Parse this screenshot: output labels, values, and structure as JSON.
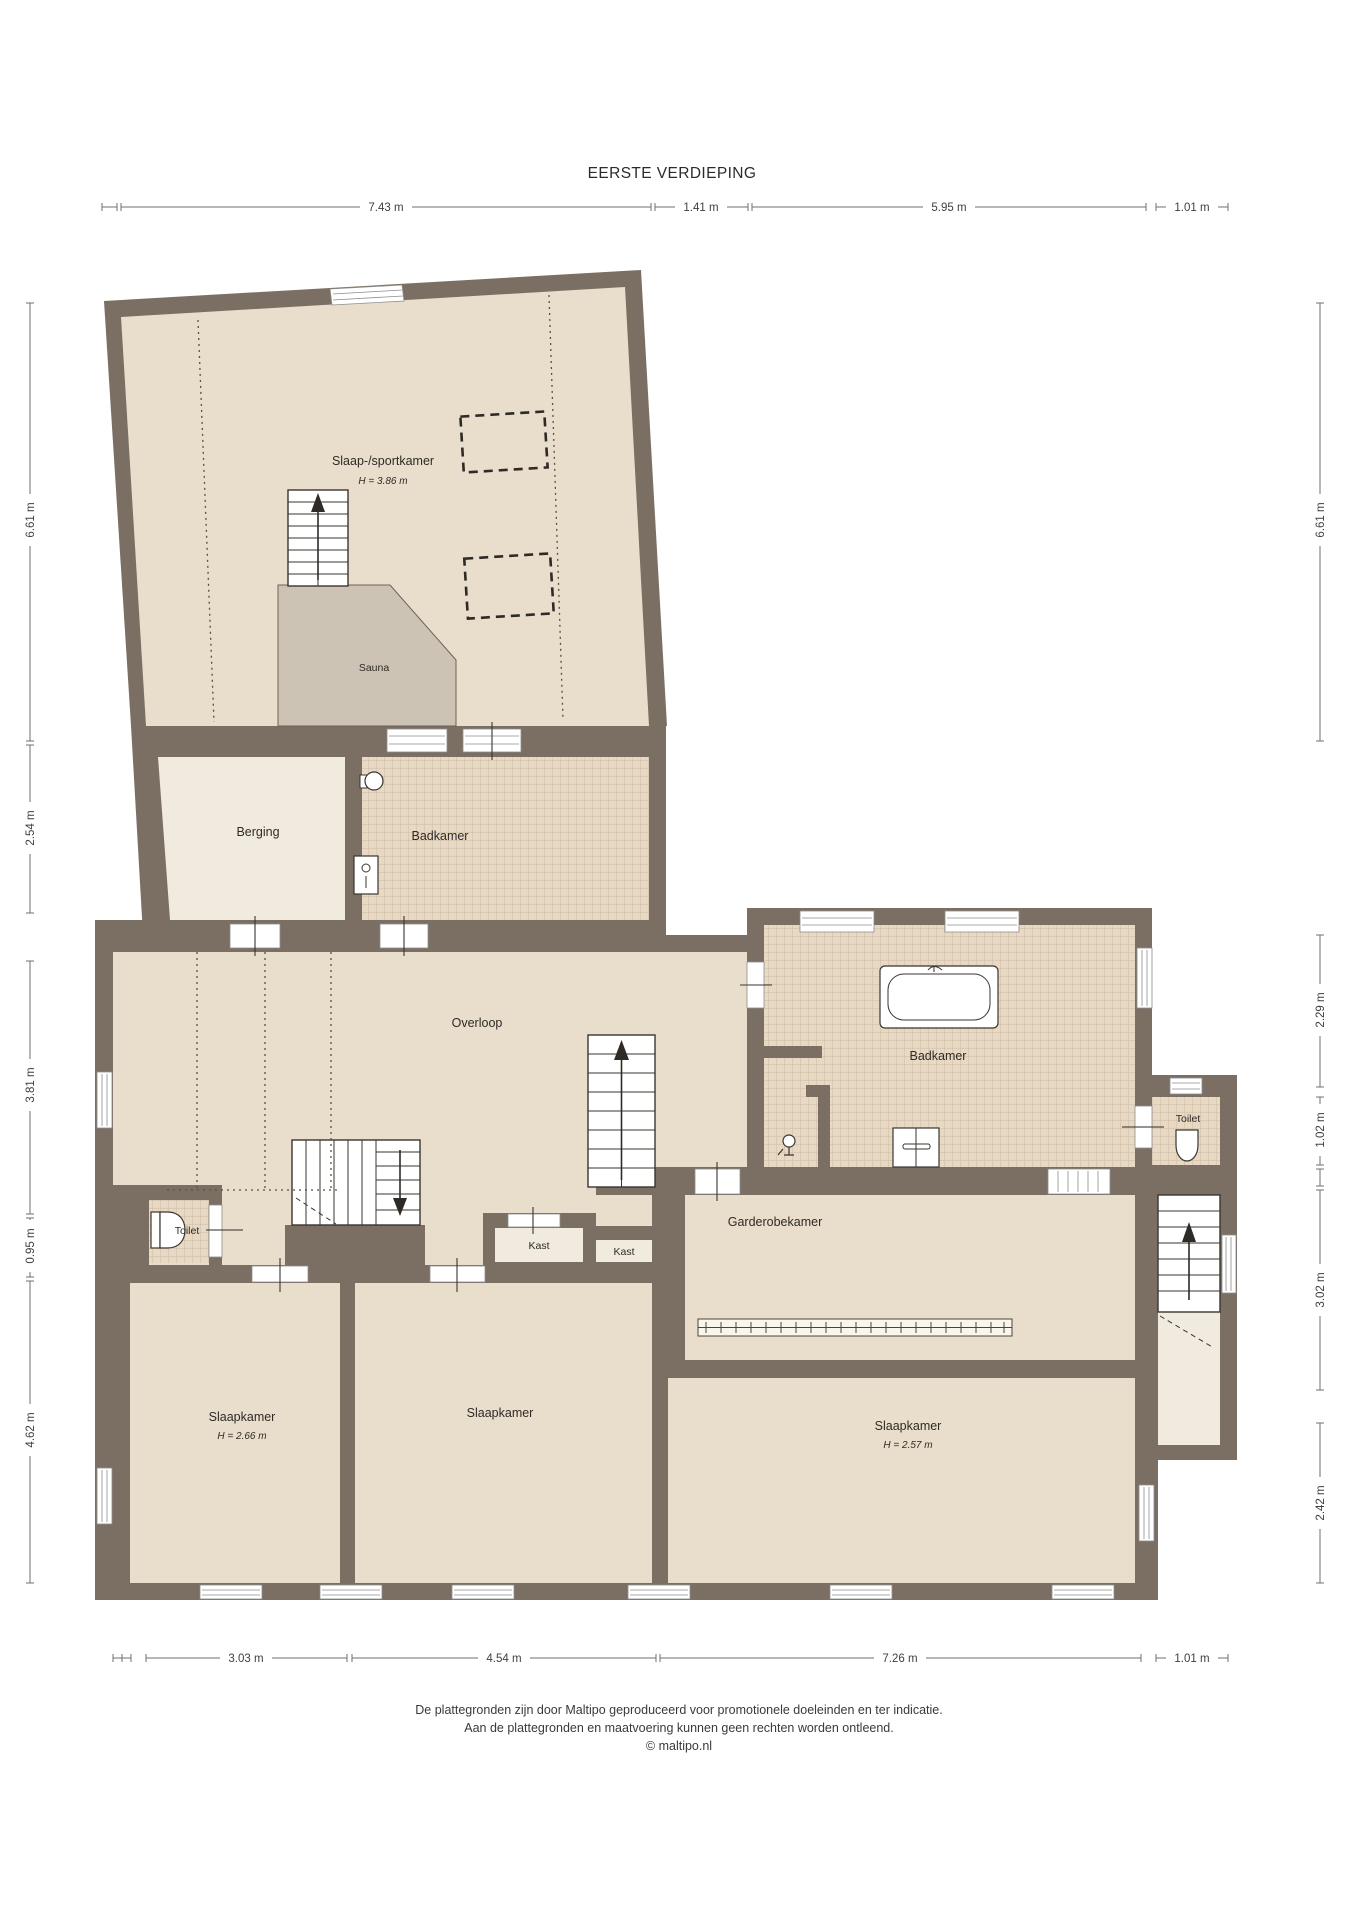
{
  "title": "EERSTE VERDIEPING",
  "rooms": {
    "sport": {
      "label": "Slaap-/sportkamer",
      "height": "H = 3.86 m"
    },
    "sauna": {
      "label": "Sauna"
    },
    "berging": {
      "label": "Berging"
    },
    "badkamer_boven": {
      "label": "Badkamer"
    },
    "overloop": {
      "label": "Overloop"
    },
    "badkamer": {
      "label": "Badkamer"
    },
    "toilet_rechts": {
      "label": "Toilet"
    },
    "toilet_links": {
      "label": "Toilet"
    },
    "garderobekamer": {
      "label": "Garderobekamer"
    },
    "kast_1": {
      "label": "Kast"
    },
    "kast_2": {
      "label": "Kast"
    },
    "slaapkamer_links": {
      "label": "Slaapkamer",
      "height": "H = 2.66 m"
    },
    "slaapkamer_midden": {
      "label": "Slaapkamer"
    },
    "slaapkamer_rechts": {
      "label": "Slaapkamer",
      "height": "H = 2.57 m"
    }
  },
  "dims": {
    "top": [
      "7.43 m",
      "1.41 m",
      "5.95 m",
      "1.01 m"
    ],
    "bottom": [
      "3.03 m",
      "4.54 m",
      "7.26 m",
      "1.01 m"
    ],
    "left": [
      "6.61 m",
      "2.54 m",
      "3.81 m",
      "0.95 m",
      "4.62 m"
    ],
    "right": [
      "6.61 m",
      "2.29 m",
      "1.02 m",
      "3.02 m",
      "2.42 m"
    ]
  },
  "footer": {
    "line1": "De plattegronden zijn door Maltipo geproduceerd voor promotionele doeleinden en ter indicatie.",
    "line2": "Aan de plattegronden en maatvoering kunnen geen rechten worden ontleend.",
    "line3": "© maltipo.nl"
  },
  "colors": {
    "wall": "#7b6f63",
    "room": "#e9decb",
    "room_light": "#f1eade",
    "sauna": "#cdc3b5",
    "tile": "#e8d9c4"
  }
}
